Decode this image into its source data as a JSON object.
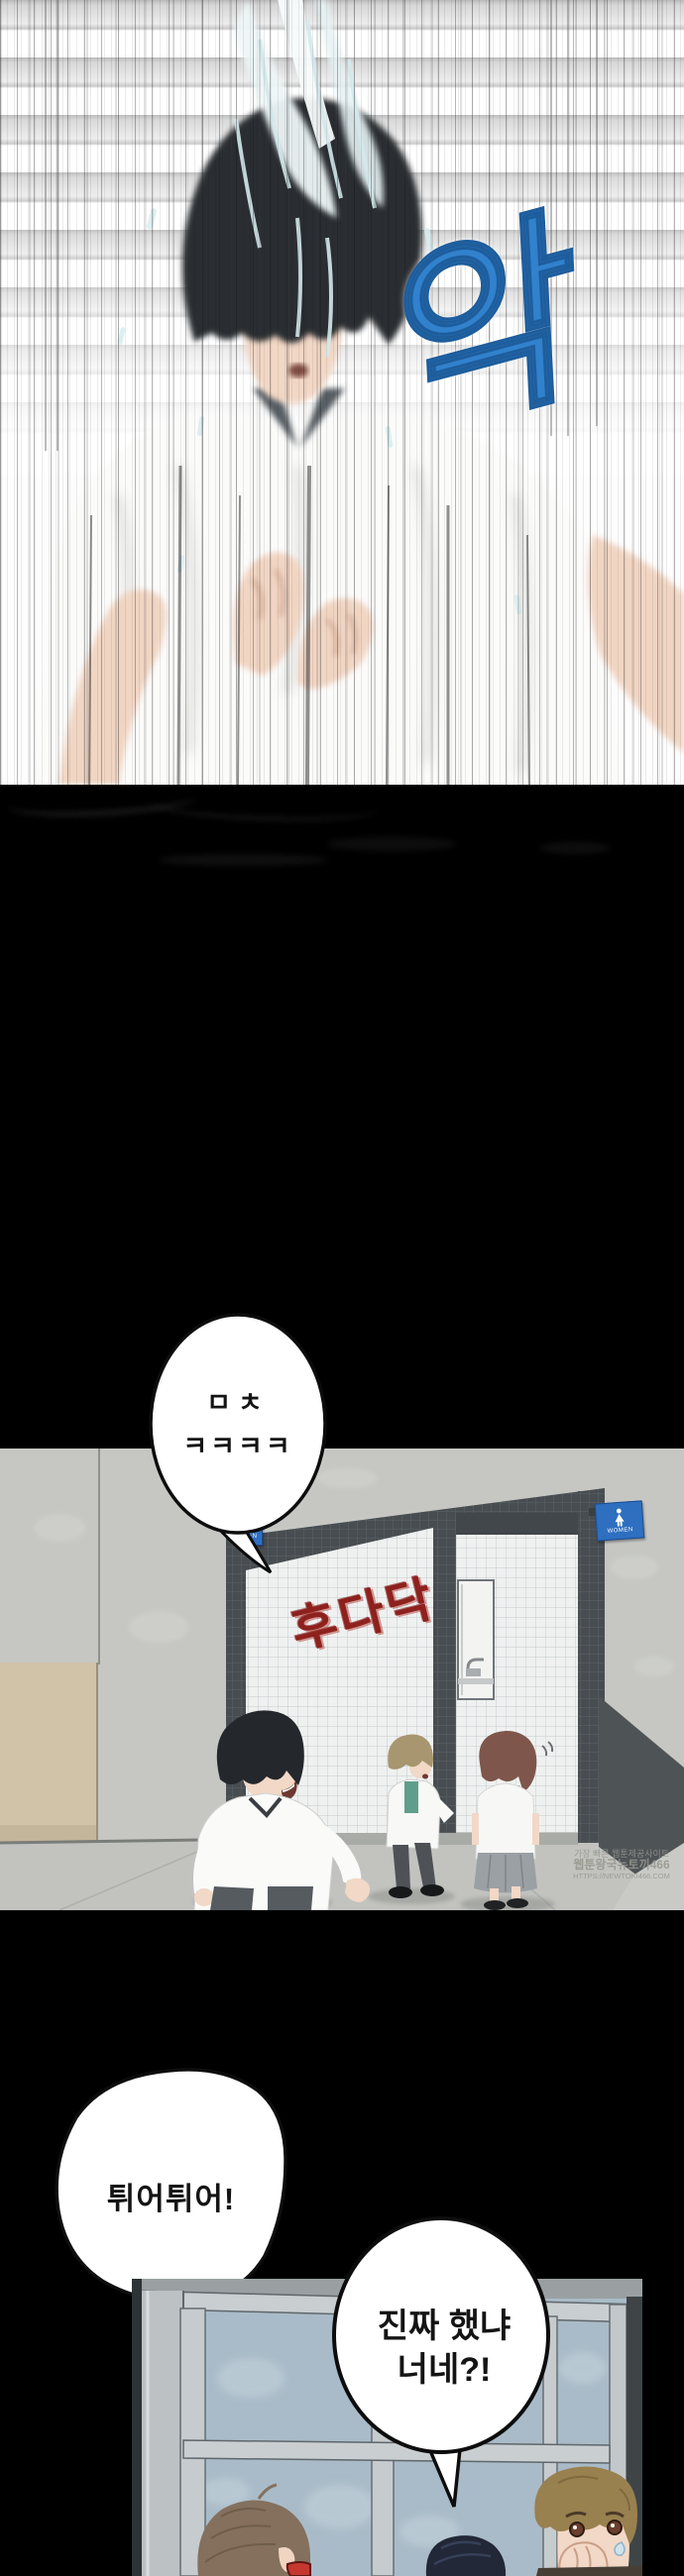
{
  "page": {
    "kind": "webtoon episode page",
    "background": "#000000"
  },
  "panel_splash": {
    "description": "boy drenched by water, motion blur, blinds background",
    "sfx": "악",
    "sfx_color": "#3181cd"
  },
  "bubble_shock": {
    "line1": "ㅁㅊ",
    "line2": "ㅋㅋㅋㅋ"
  },
  "panel_hallway": {
    "description": "students scurrying away from restroom entrance",
    "sfx": "후다닥",
    "sfx_color": "#8e211d",
    "sign_color": "#2e6fc0",
    "sign_men": {
      "label": "MEN"
    },
    "sign_women": {
      "label": "WOMEN"
    },
    "watermark": {
      "line1": "가장 빠른 웹툰제공사이트",
      "line2": "웹툰왕국뉴토끼466",
      "line3": "HTTPS://NEWTOKI466.COM"
    }
  },
  "bubble_run": {
    "text": "튀어튀어!"
  },
  "bubble_question": {
    "line1": "진짜 했냐",
    "line2": "너네?!"
  },
  "panel_classroom": {
    "description": "three students by classroom windows"
  }
}
